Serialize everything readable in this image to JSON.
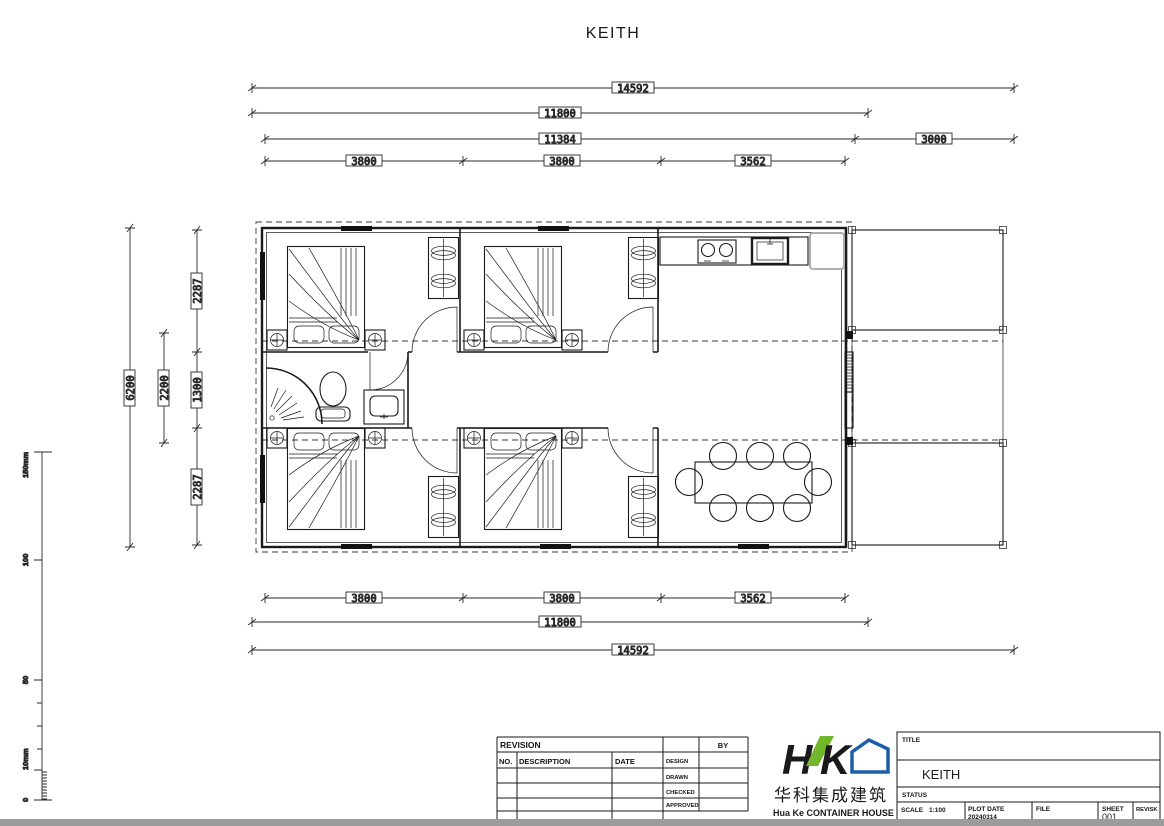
{
  "page": {
    "title": "KEITH"
  },
  "dimensions": {
    "top": {
      "overall": "14592",
      "main": "11800",
      "body": "11384",
      "extension": "3000",
      "bay1": "3800",
      "bay2": "3800",
      "bay3": "3562"
    },
    "bottom": {
      "bay1": "3800",
      "bay2": "3800",
      "bay3": "3562",
      "main": "11800",
      "overall": "14592"
    },
    "left": {
      "overall": "6200",
      "bath": "2200",
      "room_top": "2287",
      "corridor": "1300",
      "room_bottom": "2287"
    }
  },
  "ruler": {
    "max": "150mm",
    "mid": "100",
    "low": "50",
    "ten": "10mm",
    "zero": "0"
  },
  "revision_table": {
    "revision": "REVISION",
    "by": "BY",
    "no": "NO.",
    "description": "DESCRIPTION",
    "date": "DATE",
    "design": "DESIGN",
    "drawn": "DRAWN",
    "checked": "CHECKED",
    "approved": "APPROVED"
  },
  "logo": {
    "chinese": "华科集成建筑",
    "english": "Hua Ke CONTAINER HOUSE"
  },
  "title_block": {
    "title_label": "TITLE",
    "title": "KEITH",
    "status_label": "STATUS",
    "scale_label": "SCALE",
    "scale": "1:100",
    "plot_date_label": "PLOT DATE",
    "plot_date": "20240314",
    "file_label": "FILE",
    "sheet_label": "SHEET",
    "sheet": "001",
    "revision_label": "REVISK"
  },
  "colors": {
    "logo_blue": "#1a5fa8",
    "logo_green": "#72b62c",
    "line": "#1a1a1a",
    "gray_bar": "#9b9b9b"
  }
}
